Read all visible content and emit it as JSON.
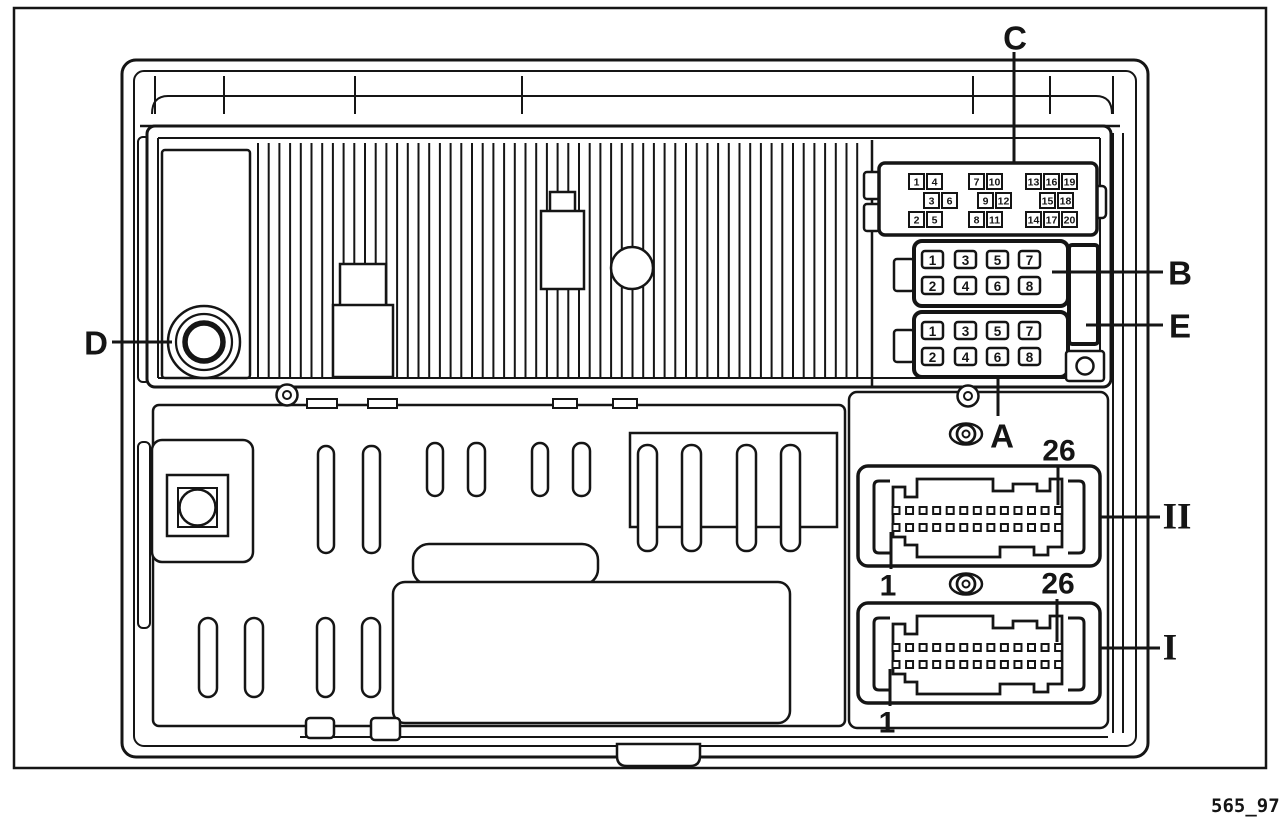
{
  "figure_code": "565_97",
  "callouts": {
    "a": "A",
    "b": "B",
    "c": "C",
    "d": "D",
    "e": "E",
    "roman_two": "II",
    "roman_one": "I",
    "ii_pin_last": "26",
    "ii_pin_first": "1",
    "i_pin_last": "26",
    "i_pin_first": "1"
  },
  "fuse_panel_c": {
    "rows": [
      {
        "y": 174,
        "xs": [
          909,
          927,
          969,
          987,
          1026,
          1044,
          1062
        ],
        "nums": [
          "1",
          "4",
          "7",
          "10",
          "13",
          "16",
          "19"
        ]
      },
      {
        "y": 193,
        "xs": [
          924,
          942,
          978,
          996,
          1040,
          1058
        ],
        "nums": [
          "3",
          "6",
          "9",
          "12",
          "15",
          "18"
        ]
      },
      {
        "y": 212,
        "xs": [
          909,
          927,
          969,
          987,
          1026,
          1044,
          1062
        ],
        "nums": [
          "2",
          "5",
          "8",
          "11",
          "14",
          "17",
          "20"
        ]
      }
    ]
  },
  "connector_b": {
    "x_cols": [
      922,
      955,
      987,
      1019
    ],
    "rows": [
      {
        "y": 251,
        "nums": [
          "1",
          "3",
          "5",
          "7"
        ]
      },
      {
        "y": 277,
        "nums": [
          "2",
          "4",
          "6",
          "8"
        ]
      }
    ]
  },
  "connector_a": {
    "x_cols": [
      922,
      955,
      987,
      1019
    ],
    "rows": [
      {
        "y": 322,
        "nums": [
          "1",
          "3",
          "5",
          "7"
        ]
      },
      {
        "y": 348,
        "nums": [
          "2",
          "4",
          "6",
          "8"
        ]
      }
    ]
  },
  "io_connectors": {
    "rows": 2,
    "cols": 13
  },
  "colors": {
    "ink": "#151515",
    "paper": "#ffffff"
  }
}
